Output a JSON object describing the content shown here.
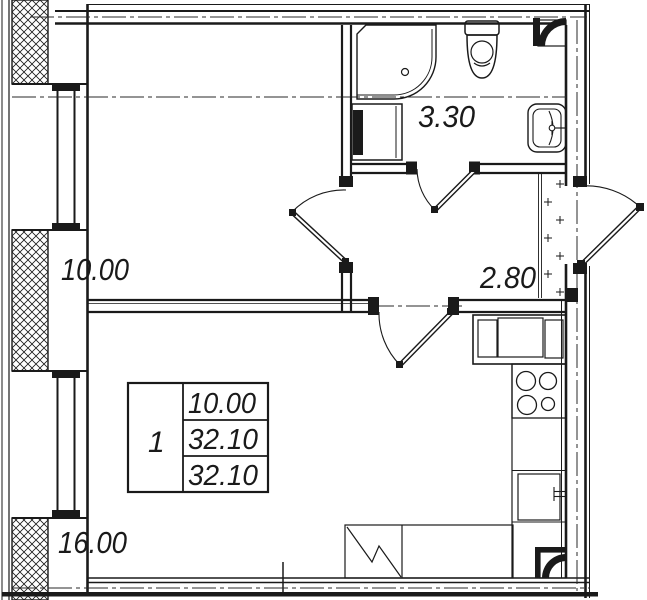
{
  "floor_plan": {
    "background": "#ffffff",
    "line_color": "#1a1a1a",
    "rooms": [
      {
        "id": "room",
        "area": "10.00"
      },
      {
        "id": "bathroom",
        "area": "3.30"
      },
      {
        "id": "hallway",
        "area": "2.80"
      },
      {
        "id": "kitchen-living-room",
        "area": "16.00"
      }
    ],
    "info_table": {
      "apartment_number": "1",
      "rows": [
        "10.00",
        "32.10",
        "32.10"
      ]
    }
  }
}
